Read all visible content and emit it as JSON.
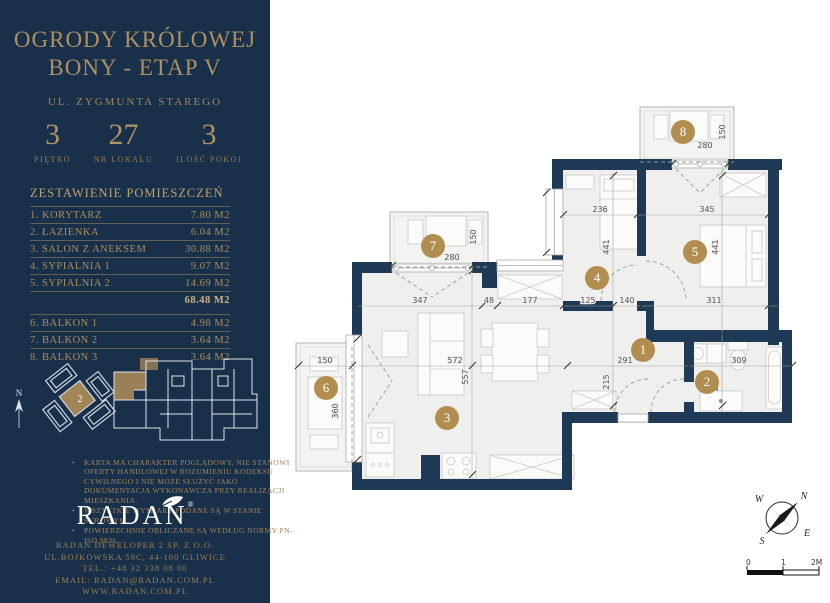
{
  "header": {
    "title_line1": "OGRODY KRÓLOWEJ",
    "title_line2": "BONY - ETAP V",
    "street": "UL. ZYGMUNTA STAREGO"
  },
  "stats": {
    "floor": {
      "value": "3",
      "label": "PIĘTRO"
    },
    "unit": {
      "value": "27",
      "label": "NR LOKALU"
    },
    "rooms": {
      "value": "3",
      "label": "ILOŚĆ POKOI"
    }
  },
  "roomlist": {
    "header": "ZESTAWIENIE POMIESZCZEŃ",
    "rows": [
      {
        "name": "1. KORYTARZ",
        "area": "7.80 M2"
      },
      {
        "name": "2. ŁAZIENKA",
        "area": "6.04 M2"
      },
      {
        "name": "3. SALON Z ANEKSEM",
        "area": "30.88 M2"
      },
      {
        "name": "4. SYPIALNIA 1",
        "area": "9.07 M2"
      },
      {
        "name": "5. SYPIALNIA 2",
        "area": "14.69 M2"
      }
    ],
    "total": "68.48 M2",
    "balconies": [
      {
        "name": "6. BALKON 1",
        "area": "4.98 M2"
      },
      {
        "name": "7. BALKON 2",
        "area": "3.64 M2"
      },
      {
        "name": "8. BALKON 3",
        "area": "3.64 M2"
      }
    ]
  },
  "sitemap": {
    "building_badge": "2",
    "north_letter": "N"
  },
  "disclaimer": [
    "KARTA MA CHARAKTER POGLĄDOWY, NIE STANOWI OFERTY HANDLOWEJ W ROZUMIENIU KODEKSU CYWILNEGO I NIE MOŻE SŁUŻYĆ JAKO DOKUMENTACJA WYKONAWCZA PRZY REALIZACJI MIESZKANIA.",
    "WSZYSTKIE WYMIARY PODANE SĄ W STANIE SUROWYM.",
    "POWIERZCHNIE OBLICZANE SĄ WEDŁUG NORMY PN-ISO 9836."
  ],
  "brand": {
    "name": "RADAN",
    "reg": "®"
  },
  "contact": [
    "RADAN DEWELOPER 2 SP. Z O.O.",
    "UL.BOJKOWSKA 59C, 44-100 GLIWICE",
    "TEL.: +48 32 338 08 00",
    "EMAIL: RADAN@RADAN.COM.PL",
    "WWW.RADAN.COM.PL"
  ],
  "plan": {
    "badges": [
      "1",
      "2",
      "3",
      "4",
      "5",
      "6",
      "7",
      "8"
    ],
    "dims": {
      "d236": "236",
      "d345": "345",
      "d347": "347",
      "d48": "48",
      "d177": "177",
      "d125": "125",
      "d140": "140",
      "d311": "311",
      "d150a": "150",
      "d572": "572",
      "d291": "291",
      "d309": "309",
      "d557": "557",
      "d441a": "441",
      "d215": "215",
      "d441b": "441",
      "d213": "213",
      "d360": "360",
      "d150b": "150",
      "d150c": "150",
      "d280a": "280",
      "d280b": "280"
    },
    "colors": {
      "wall": "#1e3a57",
      "floor": "#efefee",
      "badge_gold": "#b28d50",
      "accent_gold": "#ab8d5e"
    },
    "compass": {
      "n": "N",
      "w": "W",
      "s": "S",
      "e": "E"
    },
    "scale": {
      "zero": "0",
      "one": "1",
      "two": "2M"
    }
  }
}
